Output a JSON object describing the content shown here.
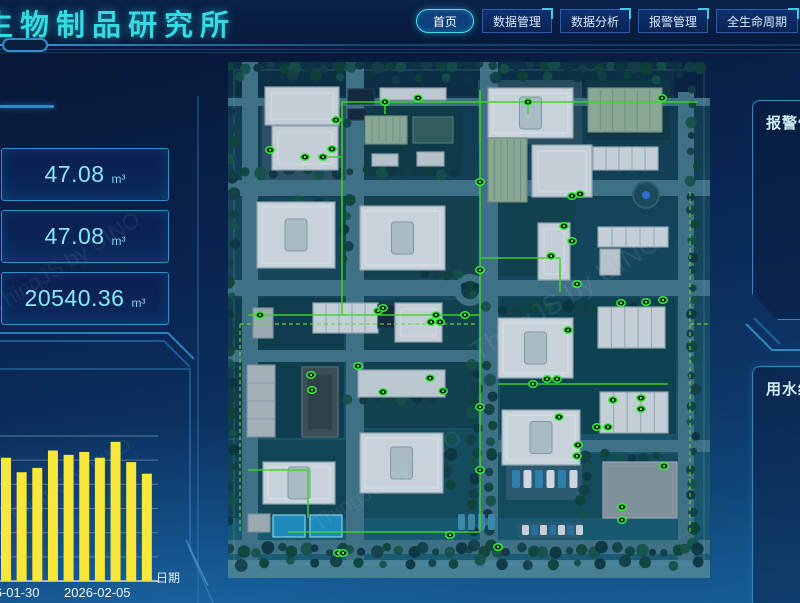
{
  "header": {
    "title": "生物制品研究所",
    "nav": [
      {
        "label": "首页",
        "active": true
      },
      {
        "label": "数据管理",
        "active": false
      },
      {
        "label": "数据分析",
        "active": false
      },
      {
        "label": "报警管理",
        "active": false
      },
      {
        "label": "全生命周期",
        "active": false
      }
    ]
  },
  "left": {
    "stats": [
      {
        "value": "47.08",
        "unit": "m³"
      },
      {
        "value": "47.08",
        "unit": "m³"
      },
      {
        "value": "20540.36",
        "unit": "m³"
      }
    ]
  },
  "chart_data": {
    "type": "bar",
    "title": "",
    "xlabel": "日期",
    "ylabel": "",
    "values": [
      85,
      75,
      78,
      90,
      87,
      89,
      85,
      96,
      82,
      74
    ],
    "x_tick_labels": [
      "2026-01-30",
      "2026-02-05"
    ],
    "ylim": [
      0,
      100
    ],
    "grid": true,
    "bar_color": "#f6e73a",
    "legend": []
  },
  "right": {
    "panels": [
      {
        "title": "报警信息"
      },
      {
        "title": "用水统计"
      }
    ]
  },
  "map": {
    "watermark": "ThingJS by UINO",
    "marker_color": "#35ef35",
    "pipe_color": "#3ed32c"
  },
  "colors": {
    "accent_cyan": "#35dbe3",
    "panel_border": "#2e8ac2",
    "stat_value": "#8ae6fa",
    "bar_yellow": "#f6e73a"
  }
}
